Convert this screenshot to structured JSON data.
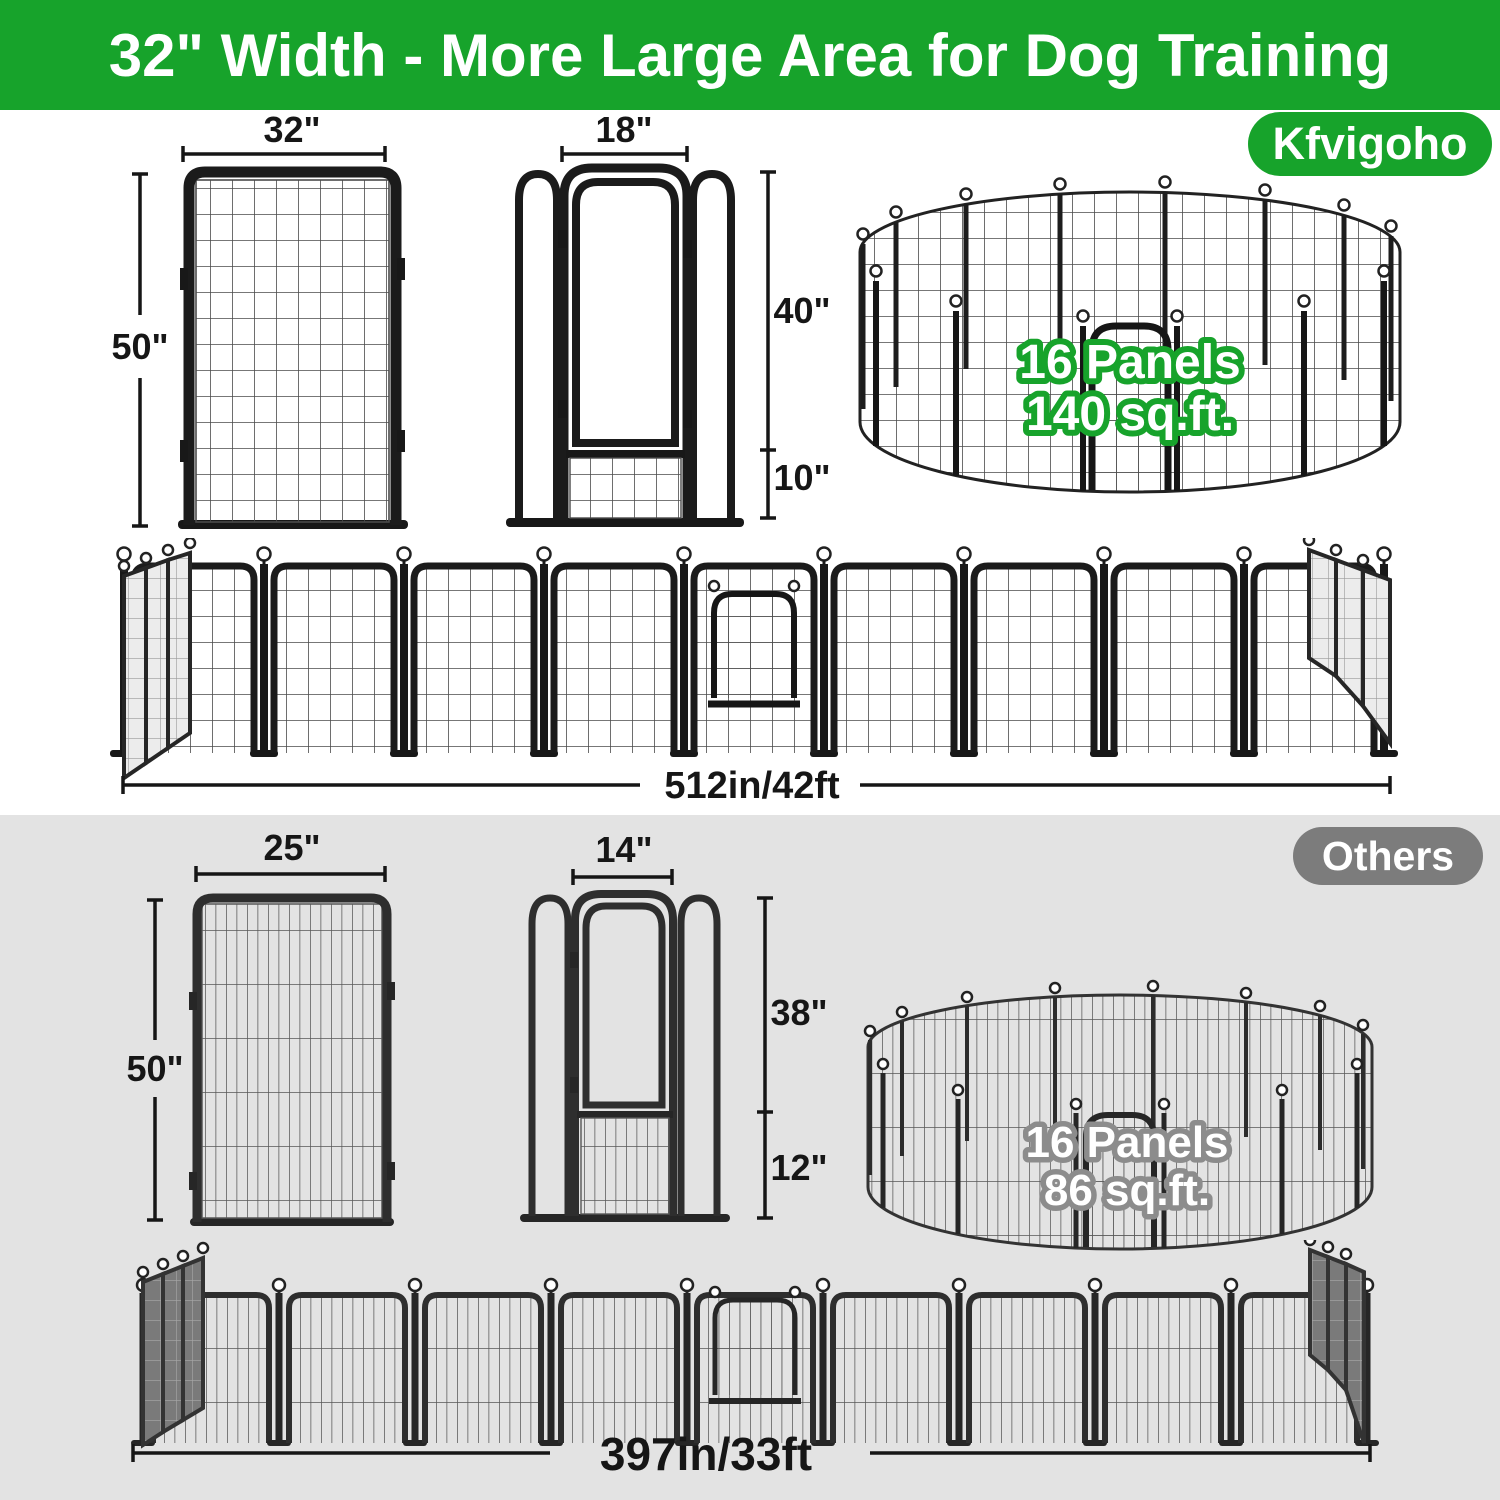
{
  "header": {
    "title": "32\" Width - More Large Area for Dog Training"
  },
  "brand": {
    "badge": "Kfvigoho",
    "panel": {
      "width": "32\"",
      "height": "50\""
    },
    "door": {
      "width": "18\"",
      "upper": "40\"",
      "lower": "10\""
    },
    "pen": {
      "panels": "16 Panels",
      "area": "140 sq.ft."
    },
    "row": {
      "total": "512in/42ft"
    }
  },
  "others": {
    "badge": "Others",
    "panel": {
      "width": "25\"",
      "height": "50\""
    },
    "door": {
      "width": "14\"",
      "upper": "38\"",
      "lower": "12\""
    },
    "pen": {
      "panels": "16 Panels",
      "area": "86 sq.ft."
    },
    "row": {
      "total": "397in/33ft"
    }
  },
  "colors": {
    "brand_green": "#17a32b",
    "others_gray": "#7c7c7c",
    "bottom_section_bg": "#e3e3e3",
    "frame_black": "#1b1b1b",
    "dimension_text": "#161616"
  }
}
